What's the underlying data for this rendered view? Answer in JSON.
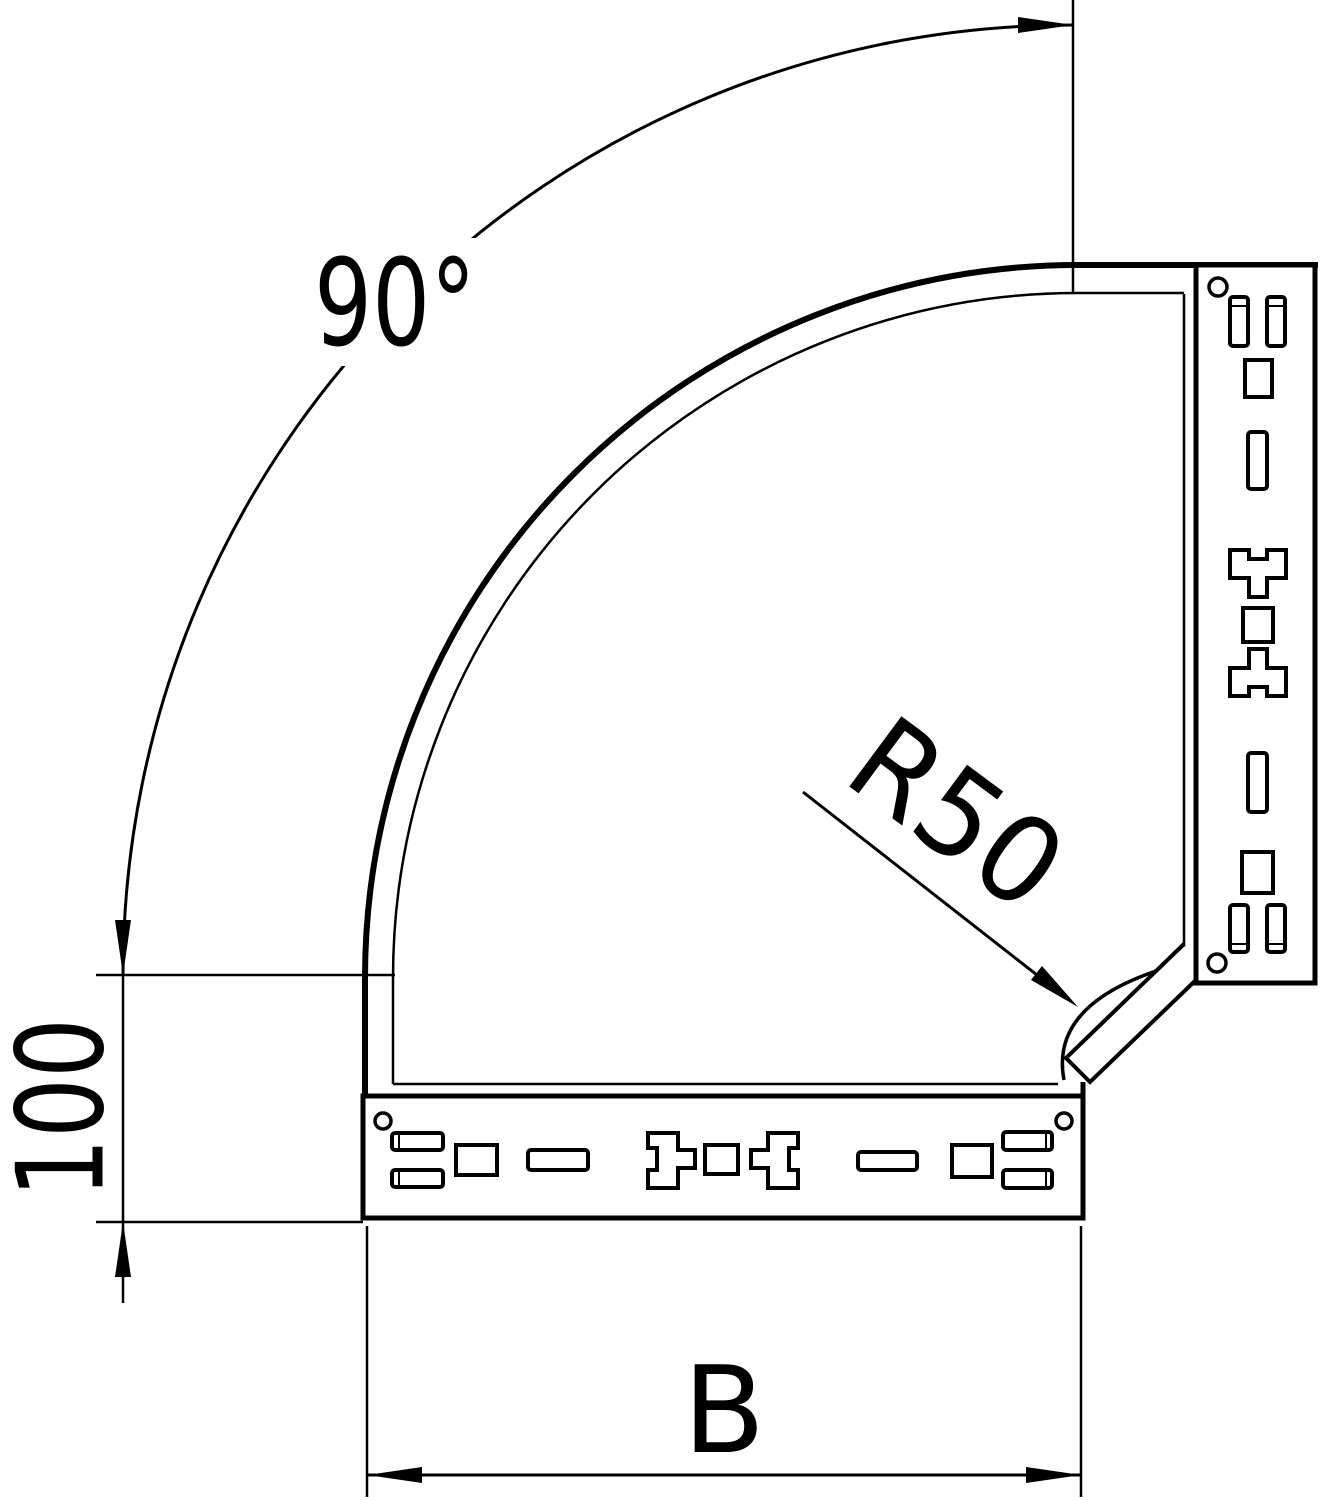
{
  "drawing": {
    "dimensions": {
      "angle_label": "90°",
      "radius_label": "R50",
      "straight_length_label": "100",
      "width_label": "B"
    },
    "colors": {
      "line": "#000000",
      "background": "#ffffff"
    }
  }
}
